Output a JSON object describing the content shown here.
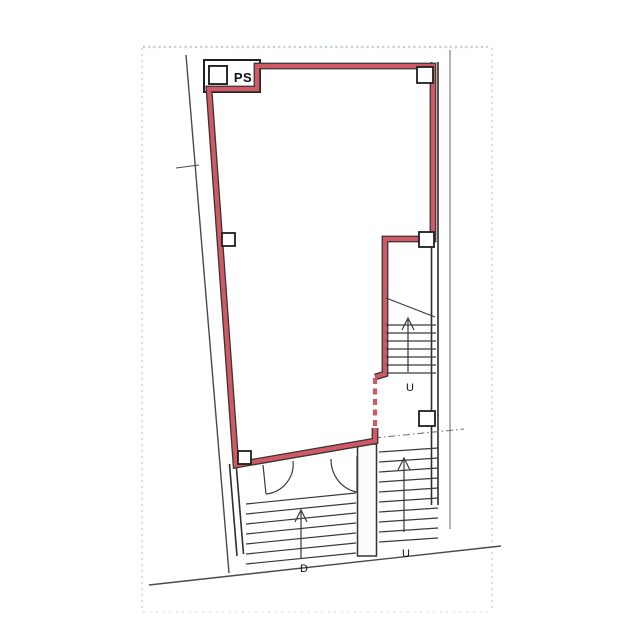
{
  "plan": {
    "labels": {
      "pipe_shaft": "PS",
      "stair_upper": "U",
      "stair_lower_right": "U",
      "stair_lower_left": "D"
    },
    "colors": {
      "lease_core": "#cf5a66",
      "lease_edge": "#3a3434",
      "wall_line": "#2e2e2e",
      "site_line": "#4a4a4a",
      "scan_border": "#b9c7d2"
    }
  }
}
